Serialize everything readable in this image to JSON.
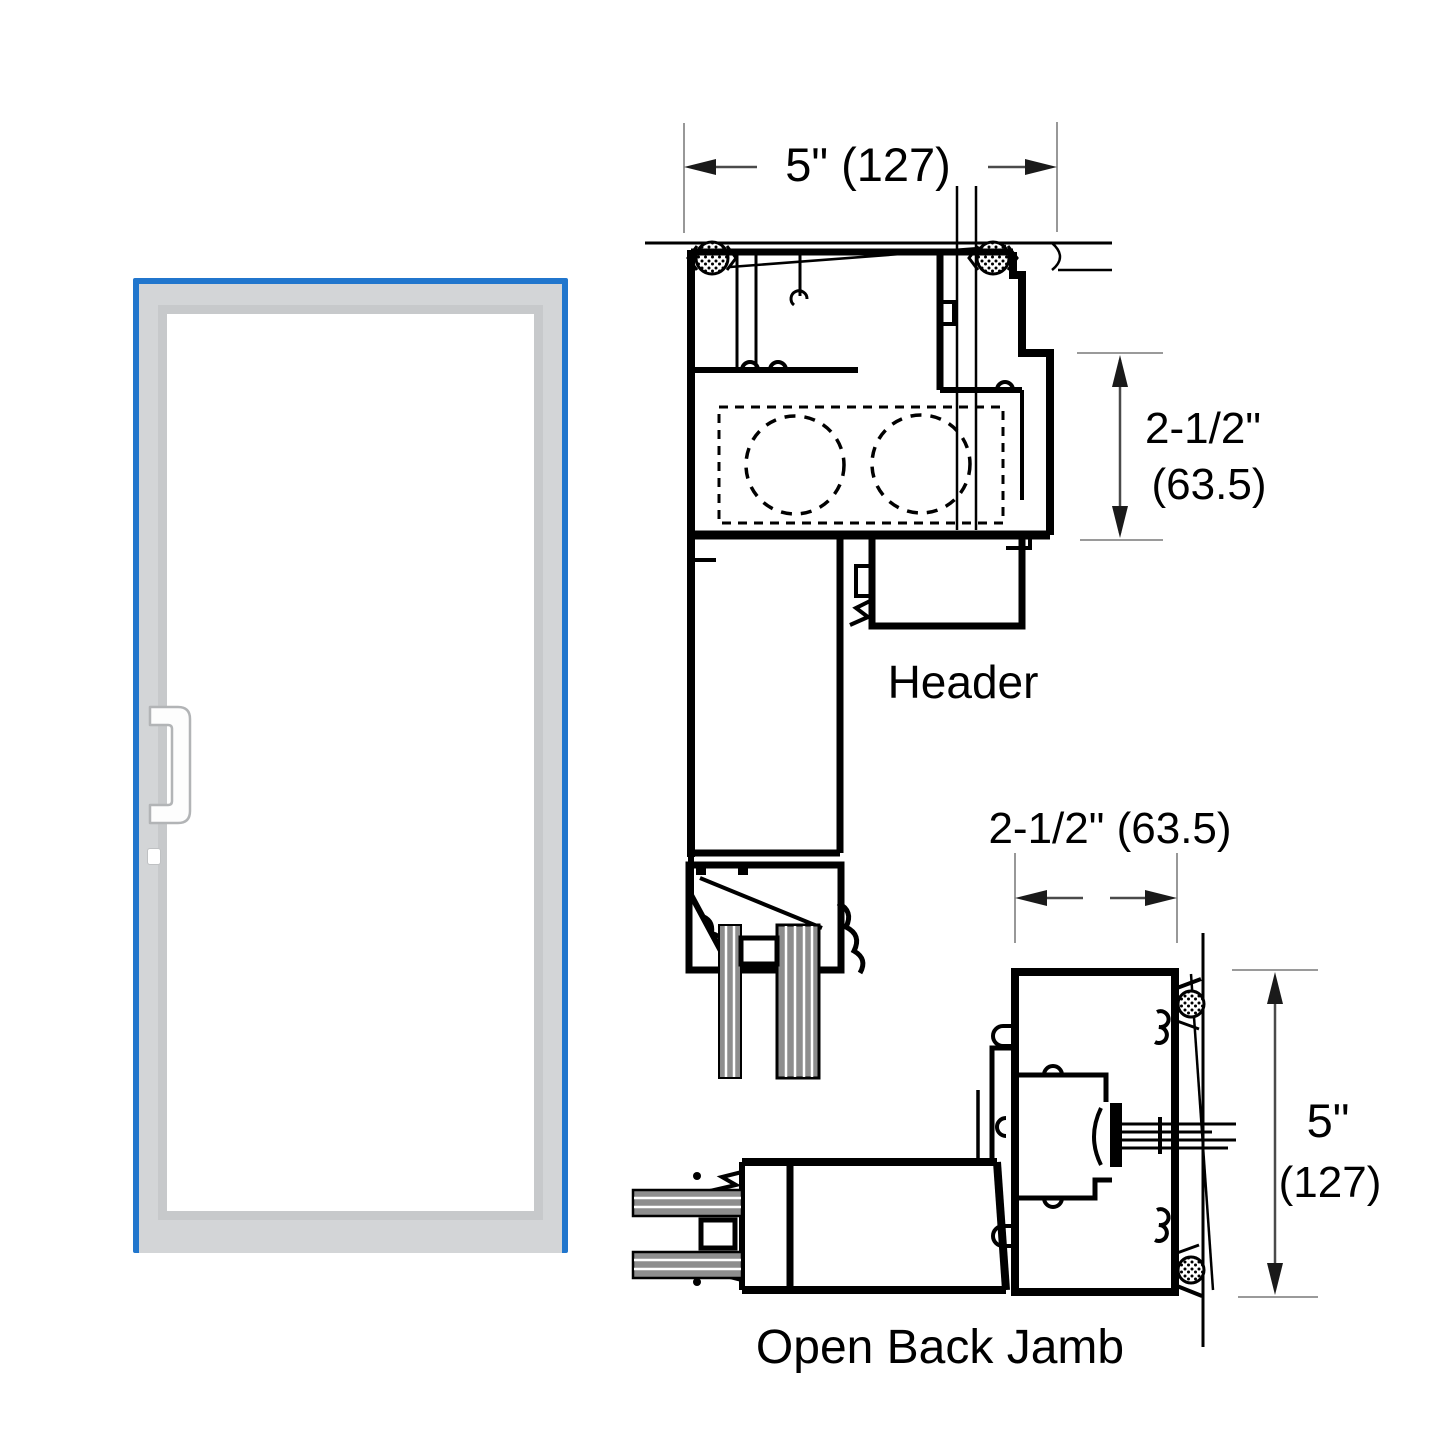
{
  "title": "Door header and open back jamb cross-section diagram",
  "door_elevation": {
    "accent_color": "#2176cd",
    "frame_color": "#d3d5d7",
    "bevel_color": "#c7c9cb",
    "glass_color": "#ffffff",
    "handle_name": "pull-handle",
    "cylinder_name": "lock-cylinder"
  },
  "header_section": {
    "label": "Header",
    "width_dimension": "5\" (127)",
    "depth_dimension_inches": "2-1/2\"",
    "depth_dimension_mm": "(63.5)"
  },
  "jamb_section": {
    "label": "Open Back Jamb",
    "width_dimension": "2-1/2\" (63.5)",
    "height_dimension_inches": "5\"",
    "height_dimension_mm": "(127)"
  }
}
